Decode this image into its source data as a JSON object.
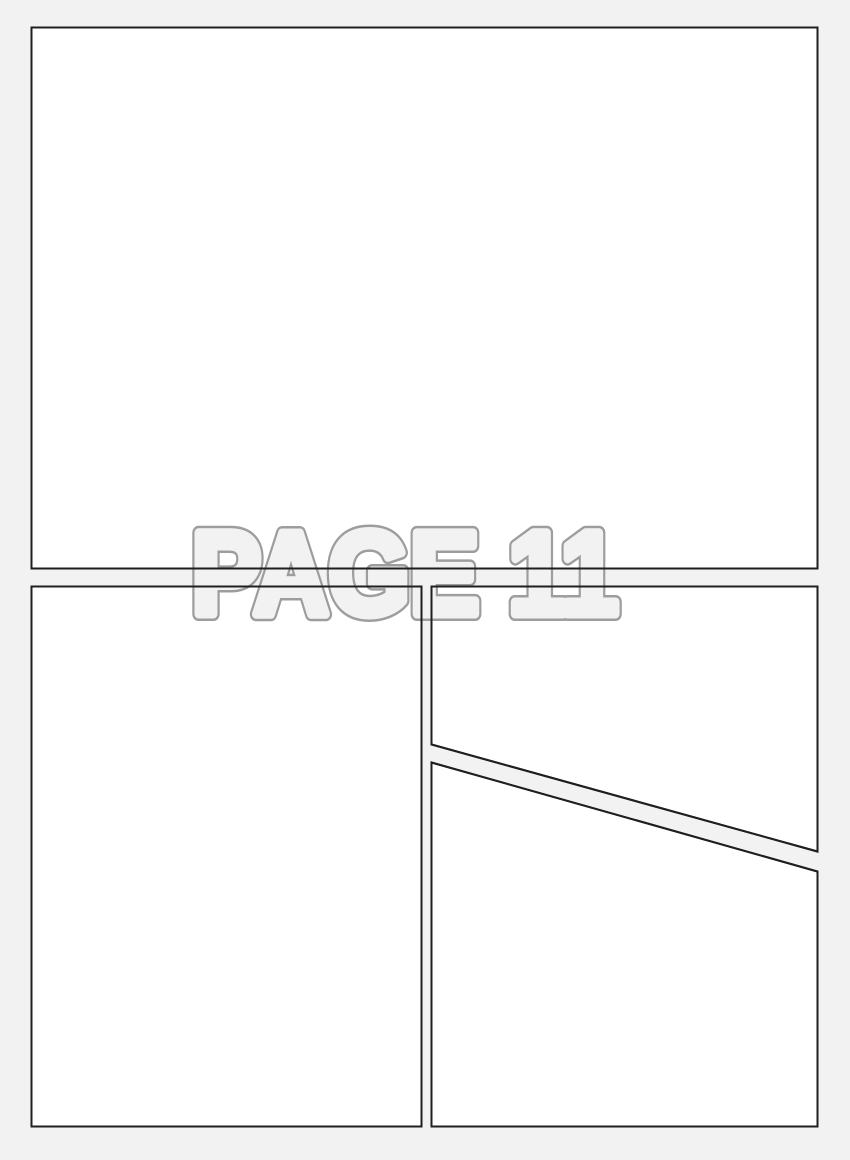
{
  "page": {
    "label": "PAGE 11",
    "panel_count": 4
  },
  "panels": [
    {
      "name": "top-full-width",
      "shape": "rectangle",
      "content": ""
    },
    {
      "name": "bottom-left",
      "shape": "rectangle",
      "content": ""
    },
    {
      "name": "top-right",
      "shape": "quadrilateral-diagonal-bottom",
      "content": ""
    },
    {
      "name": "bottom-right",
      "shape": "quadrilateral-diagonal-top",
      "content": ""
    }
  ],
  "colors": {
    "page_background": "#f2f2f2",
    "panel_fill": "#ffffff",
    "panel_border": "#1f1f1f",
    "label_fill": "#f2f2f2",
    "label_outline": "#9d9d9d"
  }
}
